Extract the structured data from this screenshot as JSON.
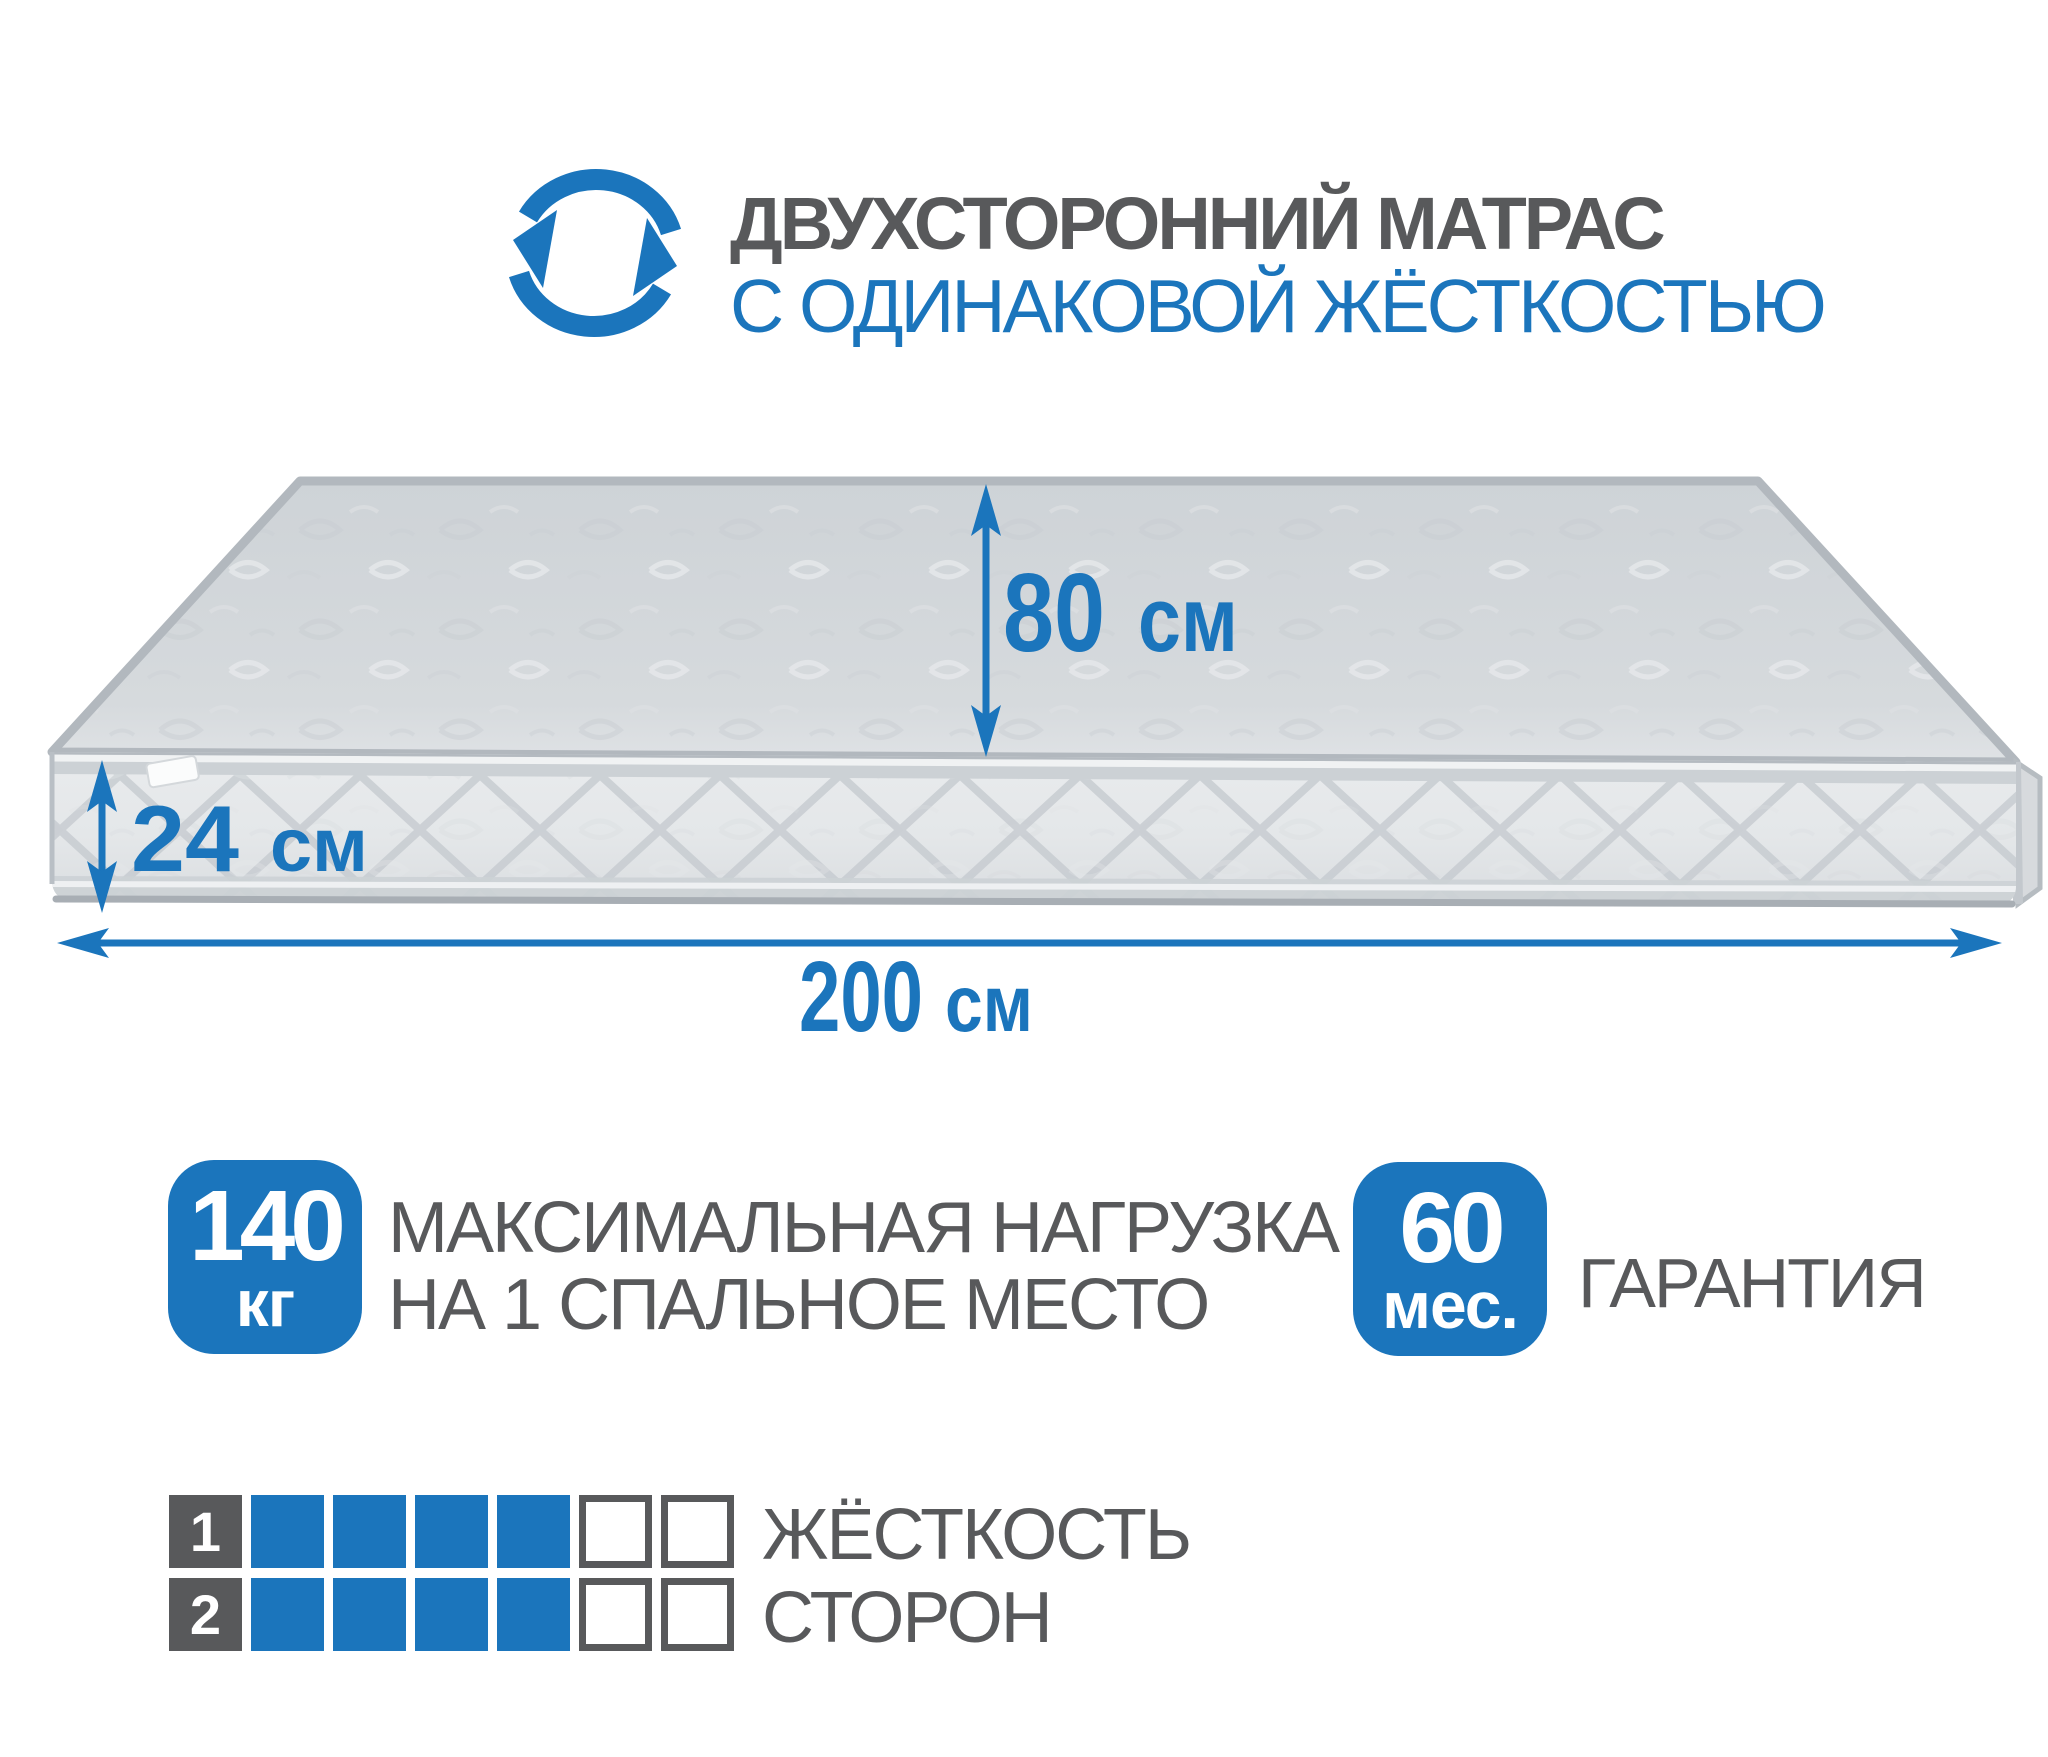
{
  "colors": {
    "accent": "#1b75bc",
    "text_gray": "#58595b"
  },
  "header": {
    "icon": "rotation-arrows-icon",
    "title_line1": "ДВУХСТОРОННИЙ МАТРАС",
    "title_line2": "С ОДИНАКОВОЙ ЖЁСТКОСТЬЮ"
  },
  "dimensions": {
    "width": {
      "value": "80",
      "unit": "см"
    },
    "height": {
      "value": "24",
      "unit": "см"
    },
    "length": {
      "value": "200",
      "unit": "см"
    }
  },
  "badges": {
    "max_load": {
      "value": "140",
      "unit": "кг",
      "description_line1": "МАКСИМАЛЬНАЯ НАГРУЗКА",
      "description_line2": "НА 1 СПАЛЬНОЕ МЕСТО"
    },
    "warranty": {
      "value": "60",
      "unit": "мес.",
      "label": "ГАРАНТИЯ"
    }
  },
  "hardness": {
    "rows": [
      {
        "label": "1",
        "filled": 4,
        "empty": 2
      },
      {
        "label": "2",
        "filled": 4,
        "empty": 2
      }
    ],
    "caption_line1": "ЖЁСТКОСТЬ",
    "caption_line2": "СТОРОН"
  }
}
